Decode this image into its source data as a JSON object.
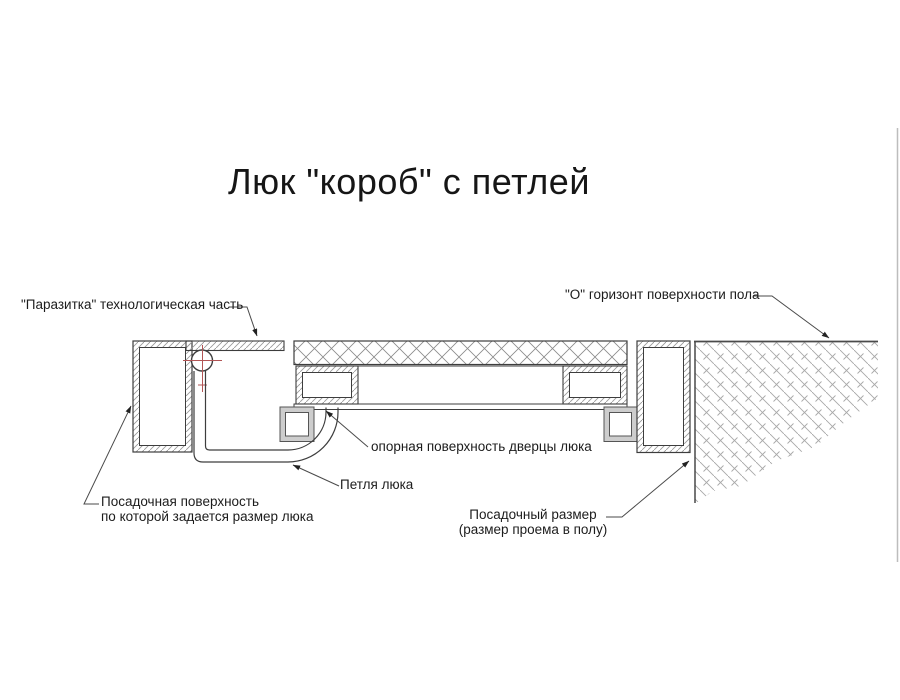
{
  "title": "Люк \"короб\" с петлей",
  "labels": {
    "parazitka": "\"Паразитка\" технологическая часть",
    "horizon": "\"О\" горизонт поверхности пола",
    "opornaya": "опорная поверхность дверцы люка",
    "petlya": "Петля люка",
    "posadochnaya_line1": "Посадочная поверхность",
    "posadochnaya_line2": "по которой задается размер люка",
    "posadochny_line1": "Посадочный размер",
    "posadochny_line2": "(размер проема в полу)"
  },
  "colors": {
    "background": "#ffffff",
    "main_line": "#3d3d3d",
    "hatch_line": "#9a9a9a",
    "crosshatch_line": "#8a8a8a",
    "floor_hatch_line": "#a8a8a8",
    "centerline_red": "#b25555",
    "leader_line": "#4a4a4a",
    "block_gray": "#cdcdcd",
    "photo_edge_gray": "#bdbdbd"
  }
}
